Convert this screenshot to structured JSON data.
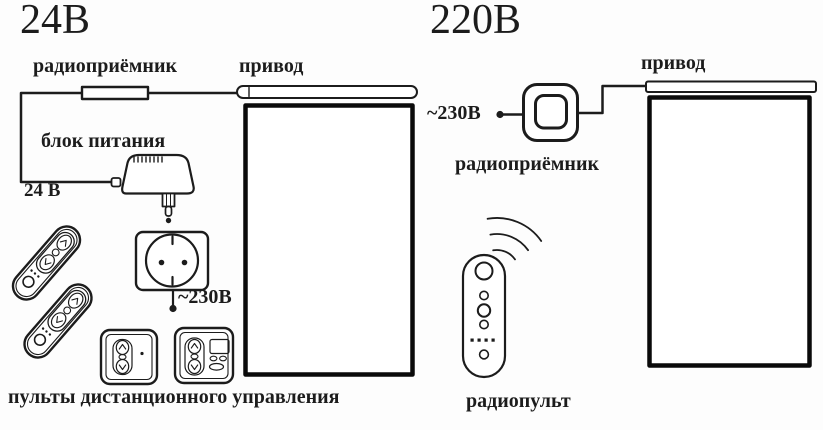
{
  "ink_color": "#1c1c1c",
  "left": {
    "title": "24В",
    "receiver_label": "радиоприёмник",
    "drive_label": "привод",
    "power_supply_label": "блок питания",
    "dc_voltage_label": "24 В",
    "mains_voltage_label": "~230В",
    "remotes_caption": "пульты дистанционного управления"
  },
  "right": {
    "title": "220В",
    "mains_voltage_label": "~230В",
    "drive_label": "привод",
    "receiver_label": "радиоприёмник",
    "remote_label": "радиопульт"
  }
}
